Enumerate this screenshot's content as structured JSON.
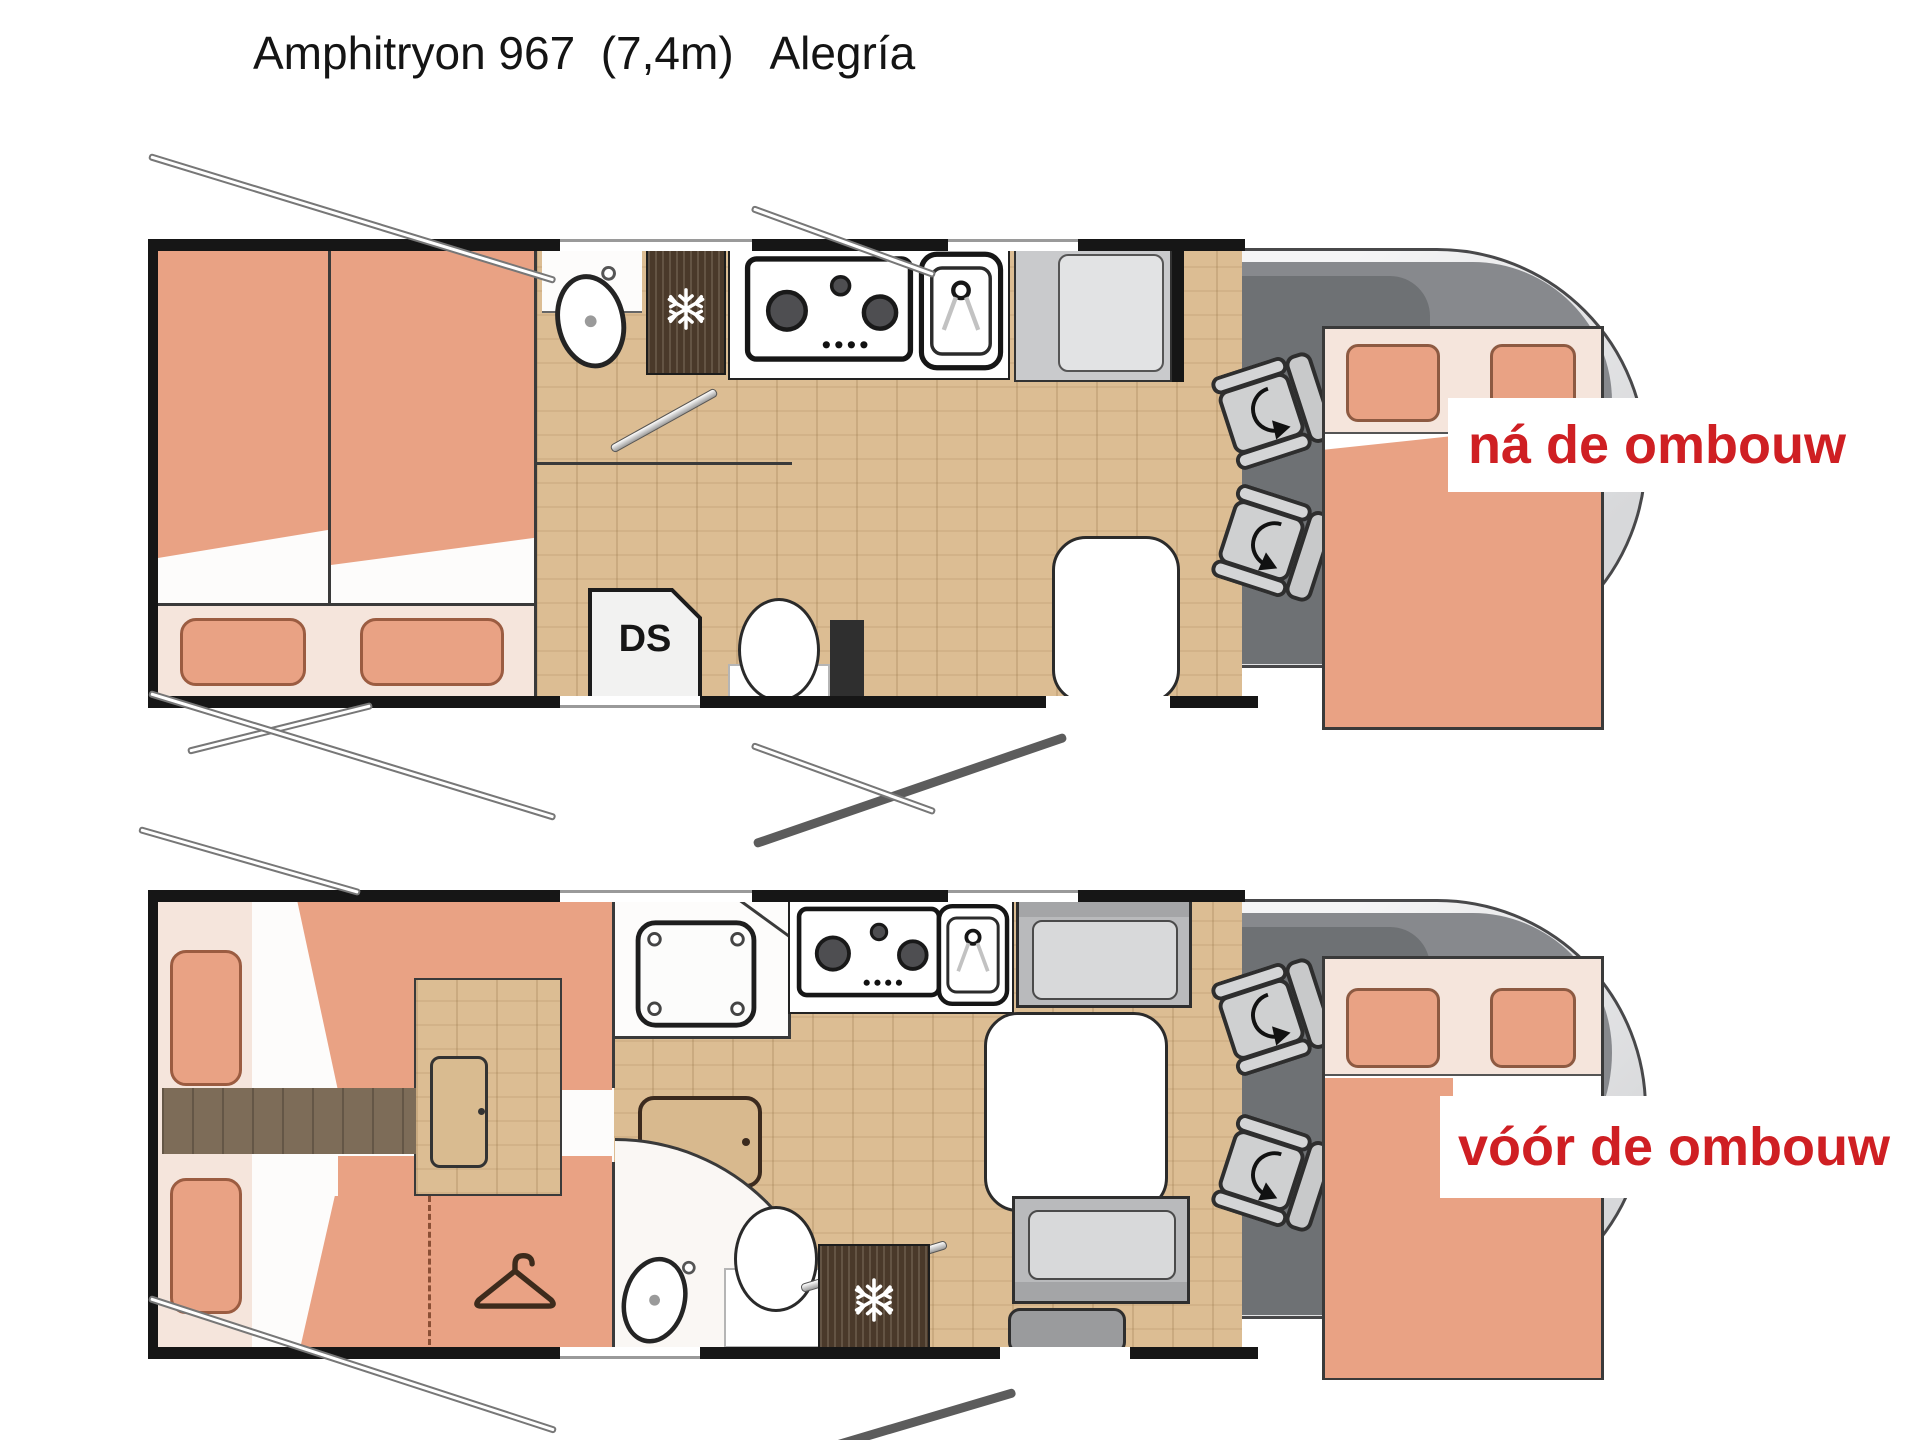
{
  "title": "Amphitryon 967  (7,4m)   Alegría",
  "plans": [
    {
      "id": "na-de-ombouw",
      "label": "ná de ombouw"
    },
    {
      "id": "voor-de-ombouw",
      "label": "vóór de ombouw"
    }
  ],
  "labels": {
    "shower_abbr": "DS"
  },
  "icons": [
    "snowflake-icon",
    "hanger-icon",
    "swivel-seat-icon",
    "stove-icon",
    "sink-icon",
    "washbasin-icon",
    "toilet-icon",
    "shower-tray-icon"
  ],
  "colors": {
    "accent_red": "#CF1F23",
    "bed_salmon": "#E9A284",
    "bed_trim": "#8D5A42",
    "floor_wood": "#DCBD93",
    "walkway_wood": "#7D6C58",
    "cab_gray": "#6E7174",
    "fridge_brown": "#4A392A",
    "wall_black": "#161616"
  }
}
